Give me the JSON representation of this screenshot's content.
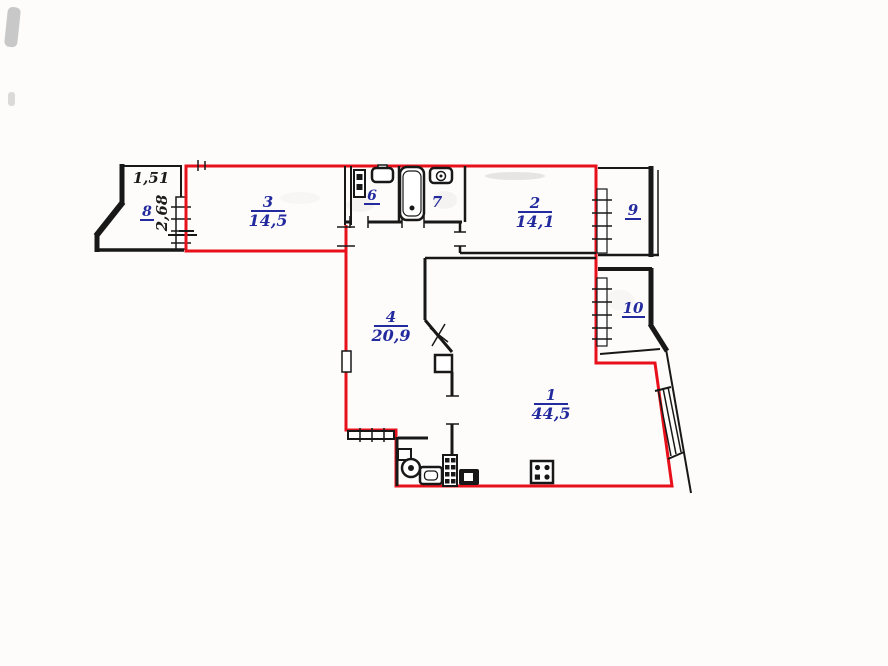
{
  "colors": {
    "boundary_red": "#e8101a",
    "label_blue": "#232a9e",
    "wall_black": "#181818",
    "paper": "#fdfcfb"
  },
  "rooms": {
    "r1": {
      "number": "1",
      "area": "44,5"
    },
    "r2": {
      "number": "2",
      "area": "14,1"
    },
    "r3": {
      "number": "3",
      "area": "14,5"
    },
    "r4": {
      "number": "4",
      "area": "20,9"
    },
    "r6": {
      "number": "6"
    },
    "r7": {
      "number": "7"
    },
    "r8": {
      "number": "8"
    },
    "r9": {
      "number": "9"
    },
    "r10": {
      "number": "10"
    }
  },
  "dimensions": {
    "balcony_width": "1,51",
    "balcony_depth": "2,68"
  },
  "icons": {
    "bathtub-icon": "rounded-rect tub with drain dot",
    "toilet-icon": "tank + round bowl",
    "washbasin-icon": "rounded square basin",
    "sink-icon": "rounded rect with faucet circle",
    "stove-icon": "square with 4 burner dots",
    "cabinet-icon": "2x4 grid cabinet",
    "counter-icon": "dark block with white inset",
    "heater-icon": "wall box with two dots",
    "vent-shaft-icon": "small thick square",
    "window-icon": "hatched wall section",
    "door-icon": "tick marks / cross swing"
  }
}
